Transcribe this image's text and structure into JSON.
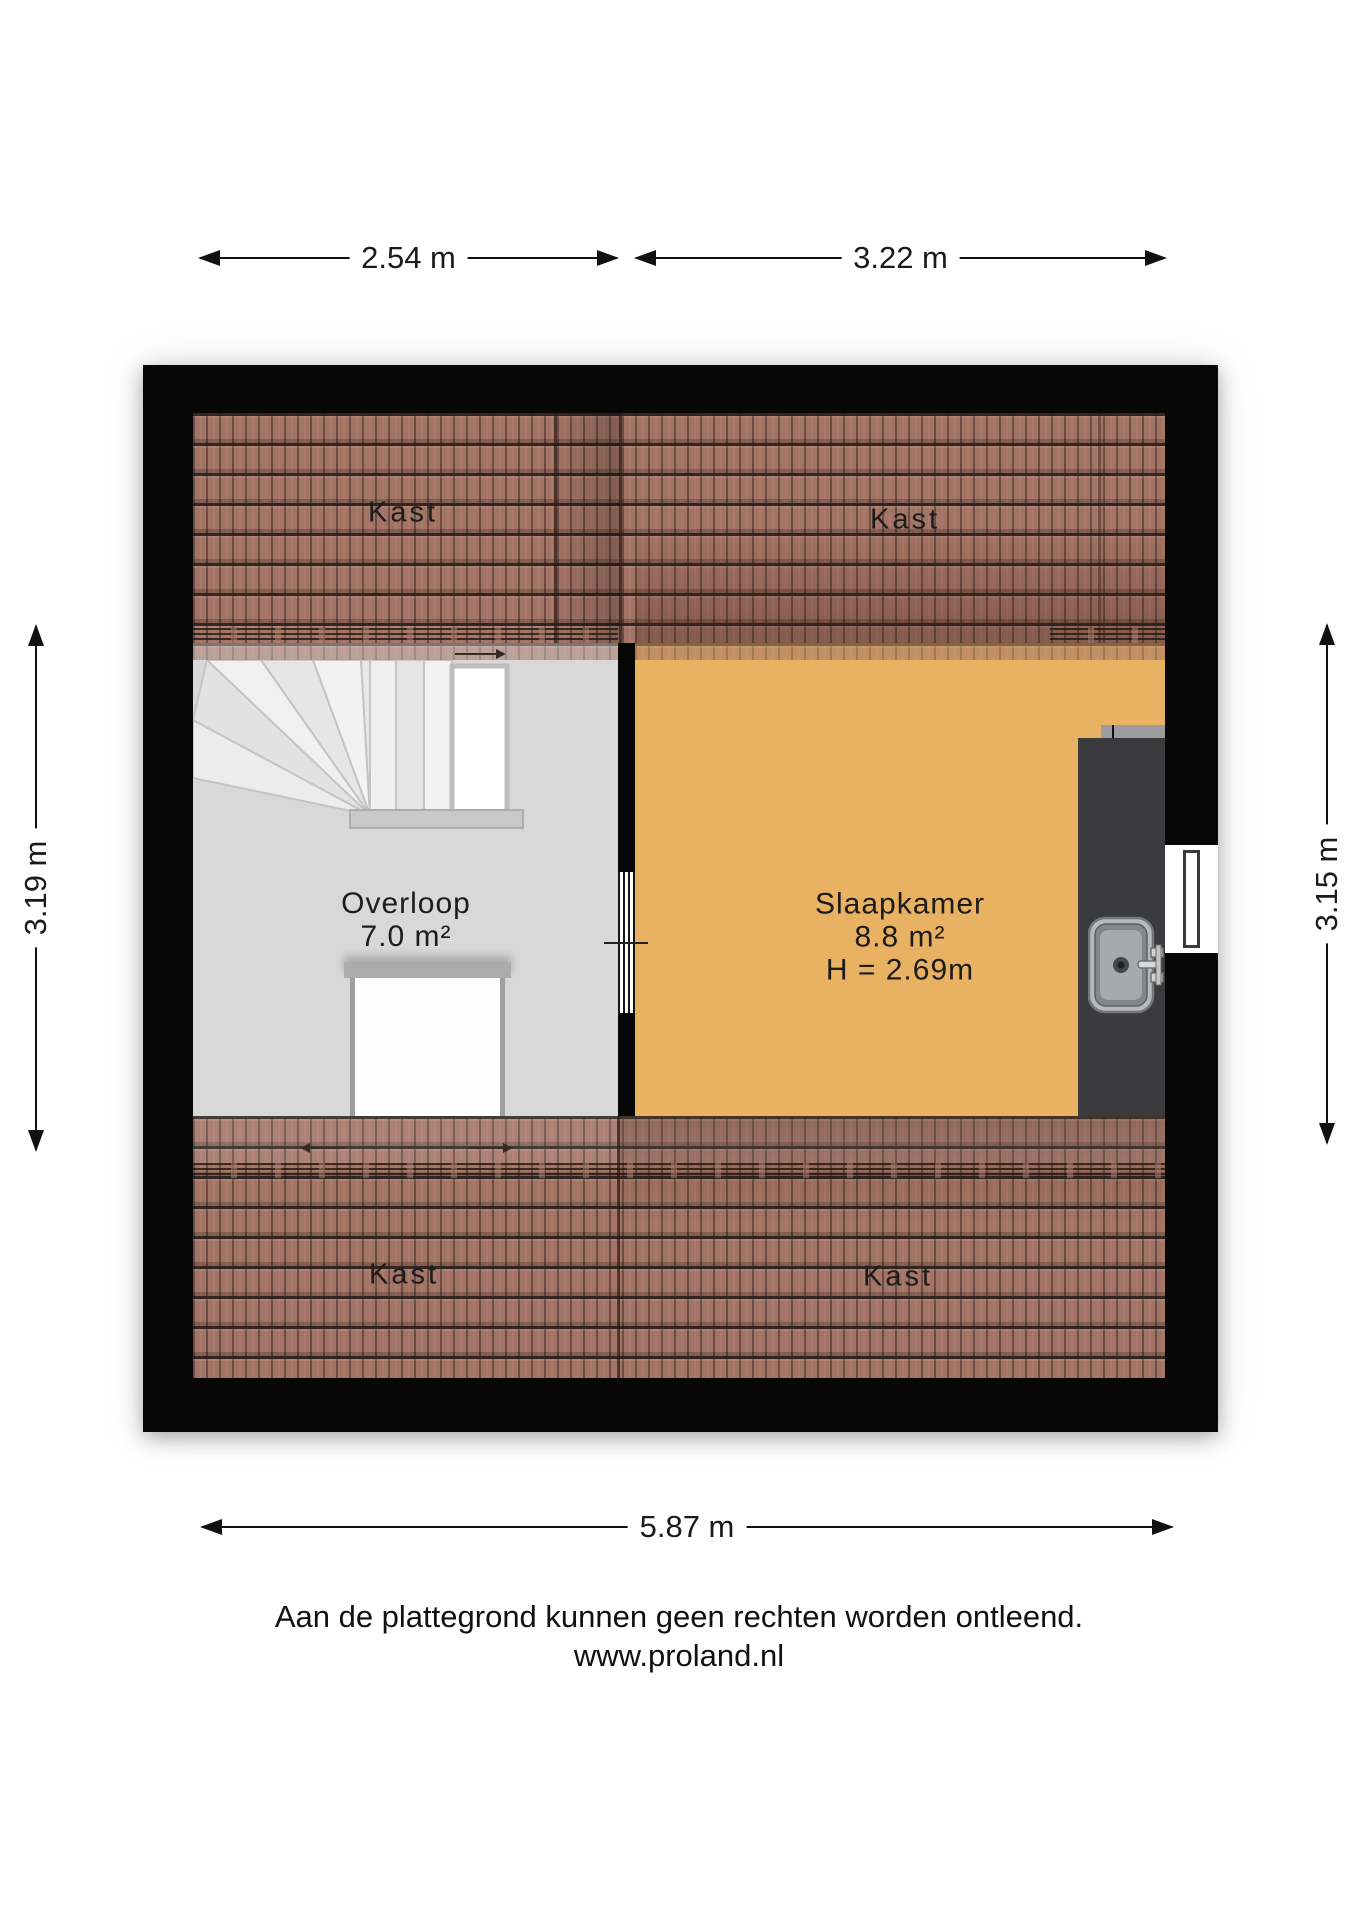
{
  "plan": {
    "rooms": {
      "kast_top_left": {
        "label": "Kast"
      },
      "kast_top_right": {
        "label": "Kast"
      },
      "kast_bottom_left": {
        "label": "Kast"
      },
      "kast_bottom_right": {
        "label": "Kast"
      },
      "overloop": {
        "name": "Overloop",
        "area": "7.0 m²"
      },
      "slaapkamer": {
        "name": "Slaapkamer",
        "area": "8.8 m²",
        "height": "H = 2.69m"
      }
    },
    "dimensions": {
      "top_left": "2.54 m",
      "top_right": "3.22 m",
      "left": "3.19 m",
      "right": "3.15 m",
      "bottom": "5.87 m"
    },
    "fixtures": {
      "stairs": "winder-stairs",
      "stair_void": "stair-opening",
      "overloop_door": "door-panel",
      "slaapkamer_door": "sliding-door",
      "counter": "counter",
      "sink": "sink-with-faucet",
      "window": "window"
    }
  },
  "footer": {
    "line1": "Aan de plattegrond kunnen geen rechten worden ontleend.",
    "line2": "www.proland.nl"
  },
  "colors": {
    "wall": "#070707",
    "tile_base": "#A27466",
    "tile_groove": "#2A1E19",
    "floor_overloop": "#D8D8D8",
    "floor_slaapkamer": "#E9B162",
    "counter": "#3B3B3D",
    "dimension_text": "#111111"
  }
}
